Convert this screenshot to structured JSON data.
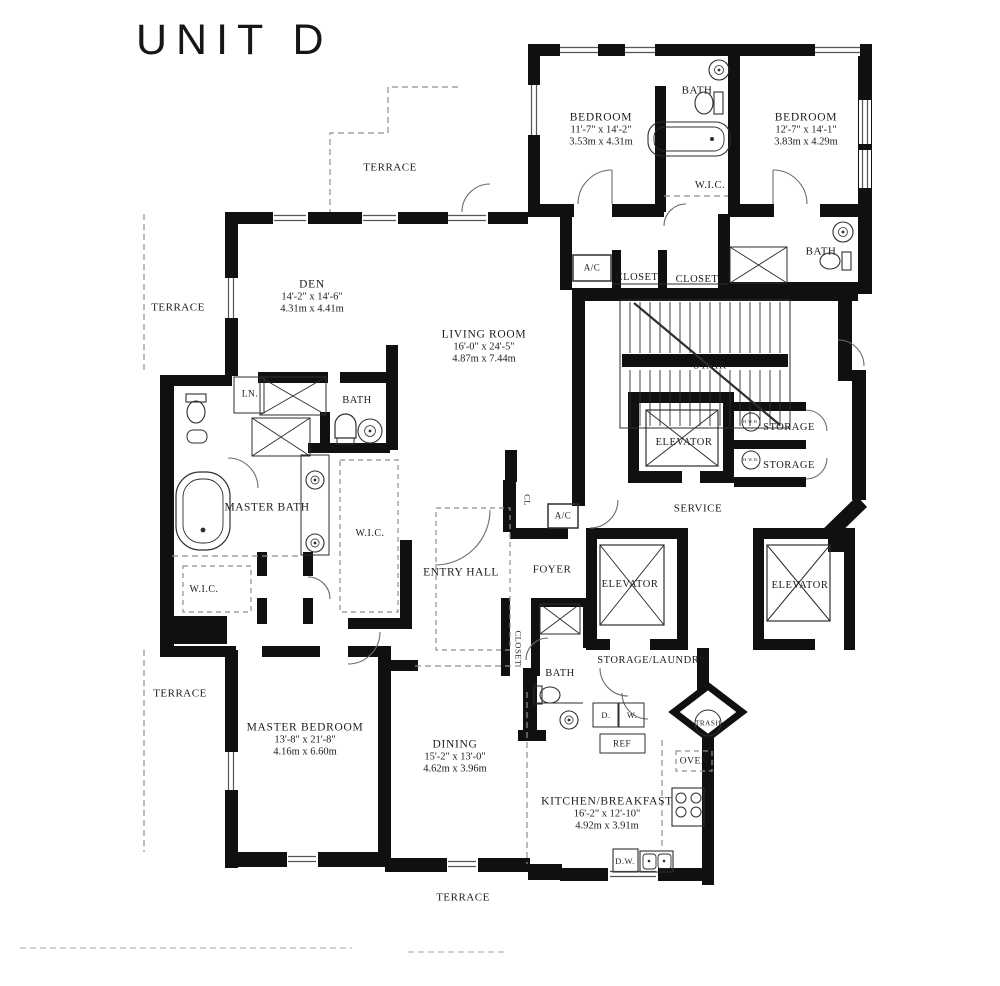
{
  "title": "UNIT D",
  "rooms": [
    {
      "id": "bedroom-1",
      "name": "BEDROOM",
      "dims_ft": "11'-7\" x 14'-2\"",
      "dims_m": "3.53m x 4.31m"
    },
    {
      "id": "bedroom-2",
      "name": "BEDROOM",
      "dims_ft": "12'-7\" x 14'-1\"",
      "dims_m": "3.83m x 4.29m"
    },
    {
      "id": "den",
      "name": "DEN",
      "dims_ft": "14'-2\" x 14'-6\"",
      "dims_m": "4.31m x 4.41m"
    },
    {
      "id": "living-room",
      "name": "LIVING ROOM",
      "dims_ft": "16'-0\" x 24'-5\"",
      "dims_m": "4.87m x 7.44m"
    },
    {
      "id": "master-bedroom",
      "name": "MASTER BEDROOM",
      "dims_ft": "13'-8\" x 21'-8\"",
      "dims_m": "4.16m x 6.60m"
    },
    {
      "id": "dining",
      "name": "DINING",
      "dims_ft": "15'-2\" x 13'-0\"",
      "dims_m": "4.62m x 3.96m"
    },
    {
      "id": "kitchen",
      "name": "KITCHEN/BREAKFAST",
      "dims_ft": "16'-2\" x 12'-10\"",
      "dims_m": "4.92m x 3.91m"
    }
  ],
  "labels": {
    "terrace": "TERRACE",
    "bath": "BATH",
    "wic": "W.I.C.",
    "closet": "CLOSET",
    "stair": "STAIR",
    "elevator": "ELEVATOR",
    "storage": "STORAGE",
    "service": "SERVICE",
    "linen": "LN.",
    "master_bath": "MASTER BATH",
    "entry_hall": "ENTRY HALL",
    "foyer": "FOYER",
    "storage_laundry": "STORAGE/LAUNDRY",
    "cl": "CL",
    "ac": "A/C",
    "ref": "REF",
    "dryer": "D.",
    "washer": "W.",
    "trash": "TRASH",
    "oven": "OVEN",
    "dishwasher": "D.W.",
    "hwh": "H.W.H."
  },
  "colors": {
    "ink": "#101010",
    "thin_line": "#2e2e2e",
    "light_line": "#8f8f8f"
  }
}
